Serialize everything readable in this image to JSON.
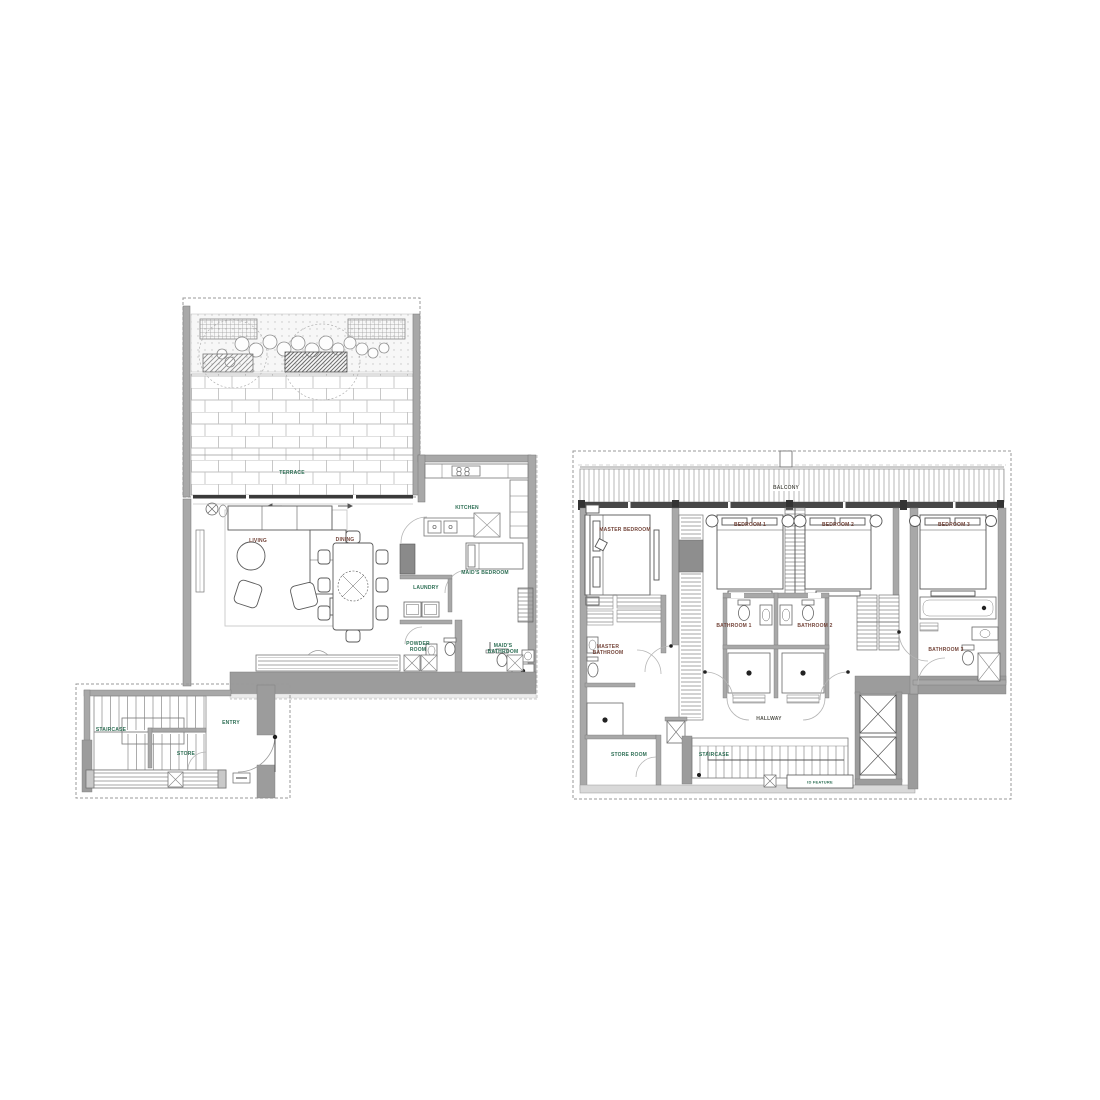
{
  "drawing": {
    "type": "residential floor plans, two levels side by side",
    "background": "#ffffff",
    "colors": {
      "wall_fill": "#a8a8a8",
      "heavy_wall_fill": "#9c9c9c",
      "line": "#666666",
      "boundary_dash": "#9a9a9a",
      "label_green": "#2d6e54",
      "label_maroon": "#74453a",
      "label_dark": "#55554e"
    }
  },
  "plans": {
    "lower": {
      "name": "lower-level-plan",
      "rooms": [
        {
          "label": "TERRACE"
        },
        {
          "label": "LIVING"
        },
        {
          "label": "DINING"
        },
        {
          "label": "KITCHEN"
        },
        {
          "label": "LAUNDRY"
        },
        {
          "label": "MAID'S BEDROOM"
        },
        {
          "label": "POWDER ROOM"
        },
        {
          "label": "MAID'S BATHROOM"
        },
        {
          "label": "ENTRY"
        },
        {
          "label": "STAIRCASE"
        },
        {
          "label": "STORE"
        }
      ]
    },
    "upper": {
      "name": "upper-level-plan",
      "rooms": [
        {
          "label": "BALCONY"
        },
        {
          "label": "MASTER BEDROOM"
        },
        {
          "label": "BEDROOM 1"
        },
        {
          "label": "BEDROOM 2"
        },
        {
          "label": "BEDROOM 3"
        },
        {
          "label": "MASTER BATHROOM"
        },
        {
          "label": "BATHROOM 1"
        },
        {
          "label": "BATHROOM 2"
        },
        {
          "label": "BATHROOM 3"
        },
        {
          "label": "HALLWAY"
        },
        {
          "label": "STORE ROOM"
        },
        {
          "label": "STAIRCASE"
        },
        {
          "label": "ID FEATURE"
        }
      ]
    }
  }
}
